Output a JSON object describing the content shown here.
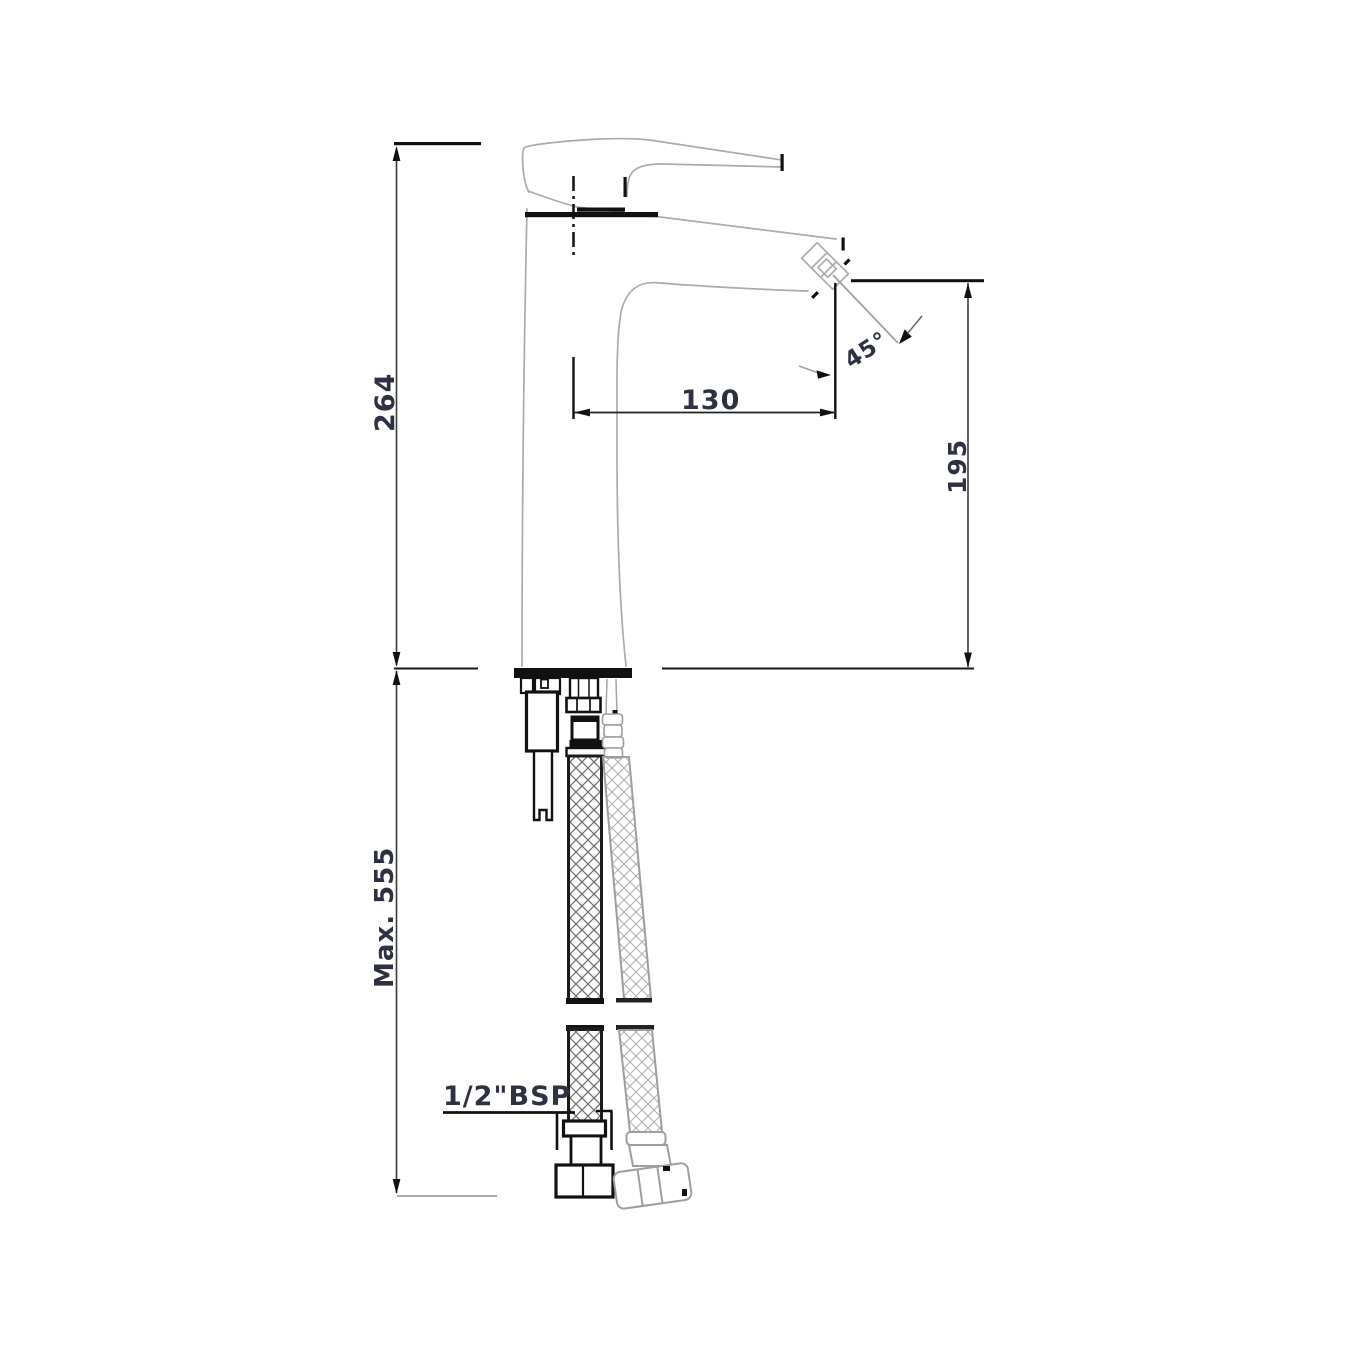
{
  "labels": {
    "overall_height": "264",
    "max_installation_depth": "Max. 555",
    "spout_reach": "130",
    "spout_height": "195",
    "aerator_angle": "45°",
    "connection_thread": "1/2\"BSP"
  },
  "colors": {
    "background": "#ffffff",
    "outline_gray": "#ababab",
    "line_black": "#111111",
    "dimension_text": "#2d3142",
    "hatch_dark": "#6e6e6e",
    "hatch_light": "#b2b2b2"
  }
}
